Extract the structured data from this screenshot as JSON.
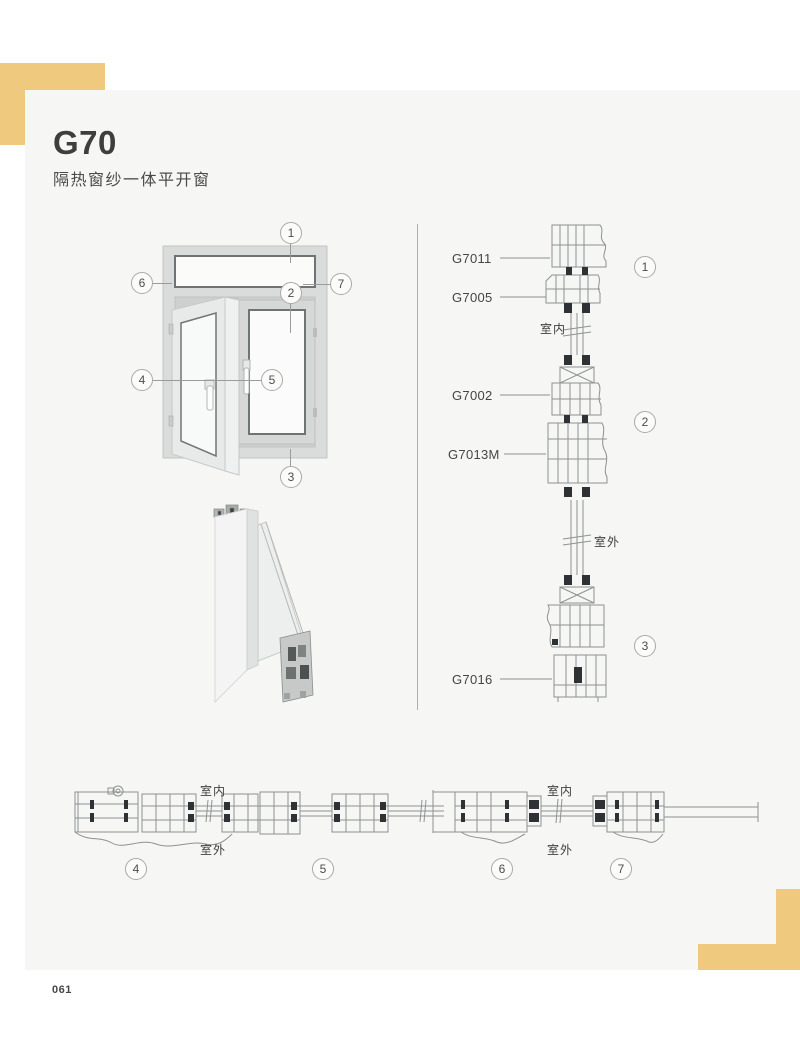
{
  "page": {
    "title": "G70",
    "subtitle": "隔热窗纱一体平开窗",
    "page_number": "061",
    "accent_color": "#EFC97E",
    "card_color": "#F6F6F4"
  },
  "window_overview": {
    "callouts": [
      "1",
      "2",
      "3",
      "4",
      "5",
      "6",
      "7"
    ]
  },
  "vertical_sections": {
    "part_labels": [
      "G7011",
      "G7005",
      "G7002",
      "G7013M",
      "G7016"
    ],
    "indoor": "室内",
    "outdoor": "室外",
    "callouts": [
      "1",
      "2",
      "3"
    ]
  },
  "horizontal_sections": {
    "left": {
      "indoor": "室内",
      "outdoor": "室外",
      "callouts": [
        "4",
        "5"
      ]
    },
    "right": {
      "indoor": "室内",
      "outdoor": "室外",
      "callouts": [
        "6",
        "7"
      ]
    }
  }
}
